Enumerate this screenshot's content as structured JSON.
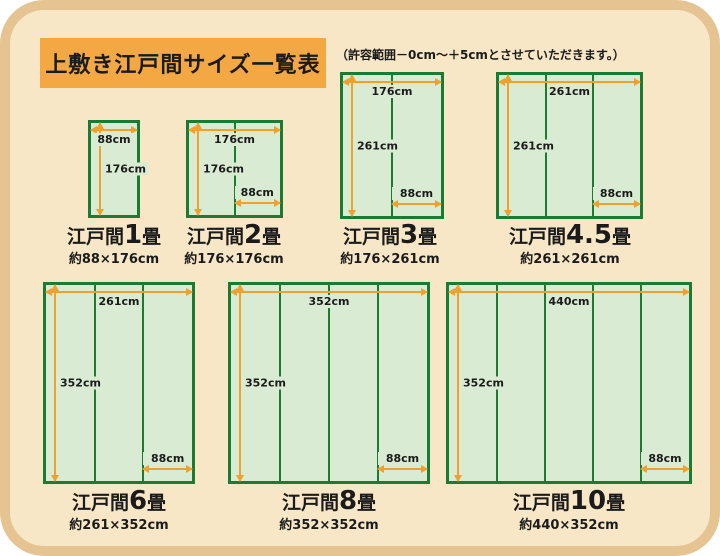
{
  "header": {
    "title": "上敷き江戸間サイズ一覧表",
    "note": "（許容範囲－0cm～＋5cmとさせていただきます。）"
  },
  "colors": {
    "card_bg": "#f7e7c6",
    "card_border": "#e5c491",
    "title_bg": "#f3a843",
    "mat_fill": "#d9ebd2",
    "mat_border": "#1c7b33",
    "arrow": "#efa12f",
    "text": "#1b1b1b"
  },
  "diagrams": [
    {
      "title_prefix": "江戸間",
      "title_number": "1",
      "title_suffix": "畳",
      "approx_size": "約88×176cm",
      "width_label": "88cm",
      "height_label": "176cm",
      "mat_count": 1
    },
    {
      "title_prefix": "江戸間",
      "title_number": "2",
      "title_suffix": "畳",
      "approx_size": "約176×176cm",
      "width_label": "176cm",
      "height_label": "176cm",
      "mat_width_label": "88cm",
      "mat_count": 2
    },
    {
      "title_prefix": "江戸間",
      "title_number": "3",
      "title_suffix": "畳",
      "approx_size": "約176×261cm",
      "width_label": "176cm",
      "height_label": "261cm",
      "mat_width_label": "88cm",
      "mat_count": 2
    },
    {
      "title_prefix": "江戸間",
      "title_number": "4.5",
      "title_suffix": "畳",
      "approx_size": "約261×261cm",
      "width_label": "261cm",
      "height_label": "261cm",
      "mat_width_label": "88cm",
      "mat_count": 3
    },
    {
      "title_prefix": "江戸間",
      "title_number": "6",
      "title_suffix": "畳",
      "approx_size": "約261×352cm",
      "width_label": "261cm",
      "height_label": "352cm",
      "mat_width_label": "88cm",
      "mat_count": 3
    },
    {
      "title_prefix": "江戸間",
      "title_number": "8",
      "title_suffix": "畳",
      "approx_size": "約352×352cm",
      "width_label": "352cm",
      "height_label": "352cm",
      "mat_width_label": "88cm",
      "mat_count": 4
    },
    {
      "title_prefix": "江戸間",
      "title_number": "10",
      "title_suffix": "畳",
      "approx_size": "約440×352cm",
      "width_label": "440cm",
      "height_label": "352cm",
      "mat_width_label": "88cm",
      "mat_count": 5
    }
  ]
}
